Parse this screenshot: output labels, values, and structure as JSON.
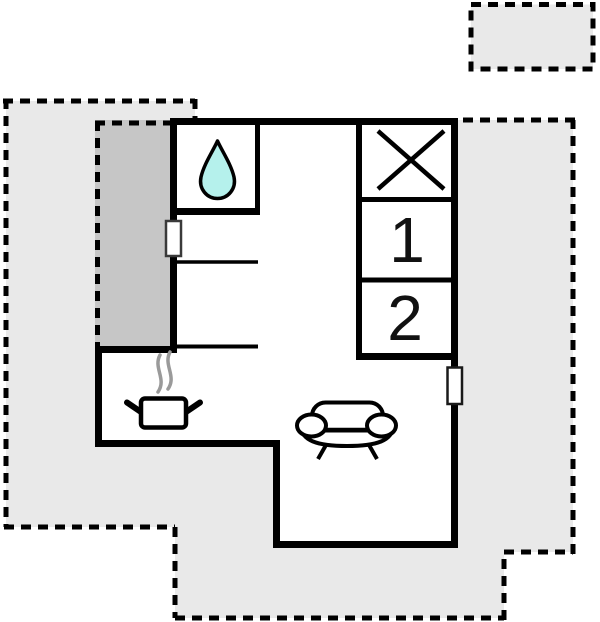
{
  "floorplan": {
    "type": "holiday-home-floor-plan",
    "rooms": {
      "bedroom_1": {
        "label": "1"
      },
      "bedroom_2": {
        "label": "2"
      }
    },
    "icons": {
      "bathroom": "water-drop-icon",
      "utility": "crossed-square-icon",
      "kitchen": "stove-pot-icon",
      "living_room": "sofa-icon"
    },
    "colors": {
      "terrace_fill": "#e9e9e9",
      "terrace_dark_fill": "#c6c6c6",
      "wall": "#000000",
      "water_drop_fill": "#b5f1ec",
      "steam": "#9a9a9a"
    }
  }
}
